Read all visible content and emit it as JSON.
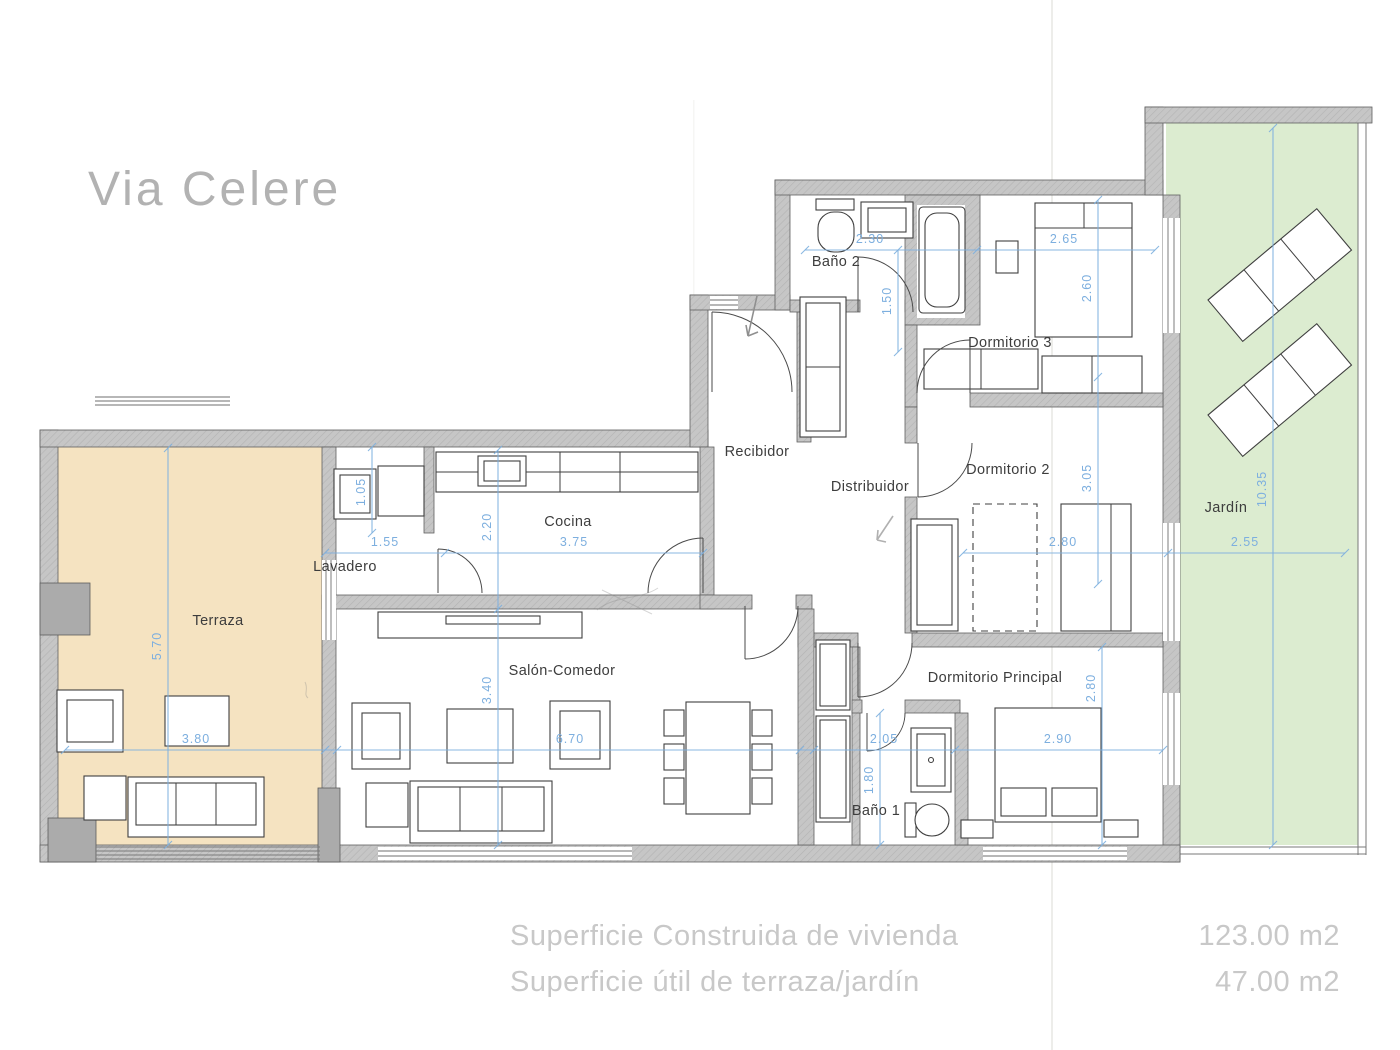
{
  "logo": "Via Celere",
  "rooms": {
    "terraza": "Terraza",
    "lavadero": "Lavadero",
    "cocina": "Cocina",
    "salon": "Salón-Comedor",
    "recibidor": "Recibidor",
    "distribuidor": "Distribuidor",
    "bano2": "Baño 2",
    "dormitorio3": "Dormitorio 3",
    "dormitorio2": "Dormitorio 2",
    "dormitorio_principal": "Dormitorio Principal",
    "bano1": "Baño 1",
    "jardin": "Jardín"
  },
  "dims": {
    "bano2_w": "2.30",
    "dorm3_w": "2.65",
    "dorm3_h": "2.60",
    "bano2_door": "1.50",
    "lav_w": "1.55",
    "lav_h": "1.05",
    "cocina_w": "3.75",
    "cocina_h": "2.20",
    "dorm2_w": "2.80",
    "dorm2_h": "3.05",
    "jardin_w": "2.55",
    "jardin_h": "10.35",
    "terraza_w": "3.80",
    "terraza_h": "5.70",
    "salon_w": "6.70",
    "salon_h": "3.40",
    "bano1_w": "2.05",
    "bano1_h": "1.80",
    "dormp_w": "2.90",
    "dormp_h": "2.80"
  },
  "summary": {
    "line1_label": "Superficie Construida de  vivienda",
    "line1_value": "123.00 m2",
    "line2_label": "Superficie útil de terraza/jardín",
    "line2_value": "47.00 m2"
  },
  "colors": {
    "wall": "#c6c6c6",
    "wall-stroke": "#606060",
    "terrace": "#f5e3c1",
    "garden": "#dcecd0",
    "dimension": "#7dafdf",
    "label": "#3d3d3d",
    "logo": "#b2b2b2",
    "summary": "#c8c8c8",
    "furn": "#3f3f3f"
  }
}
